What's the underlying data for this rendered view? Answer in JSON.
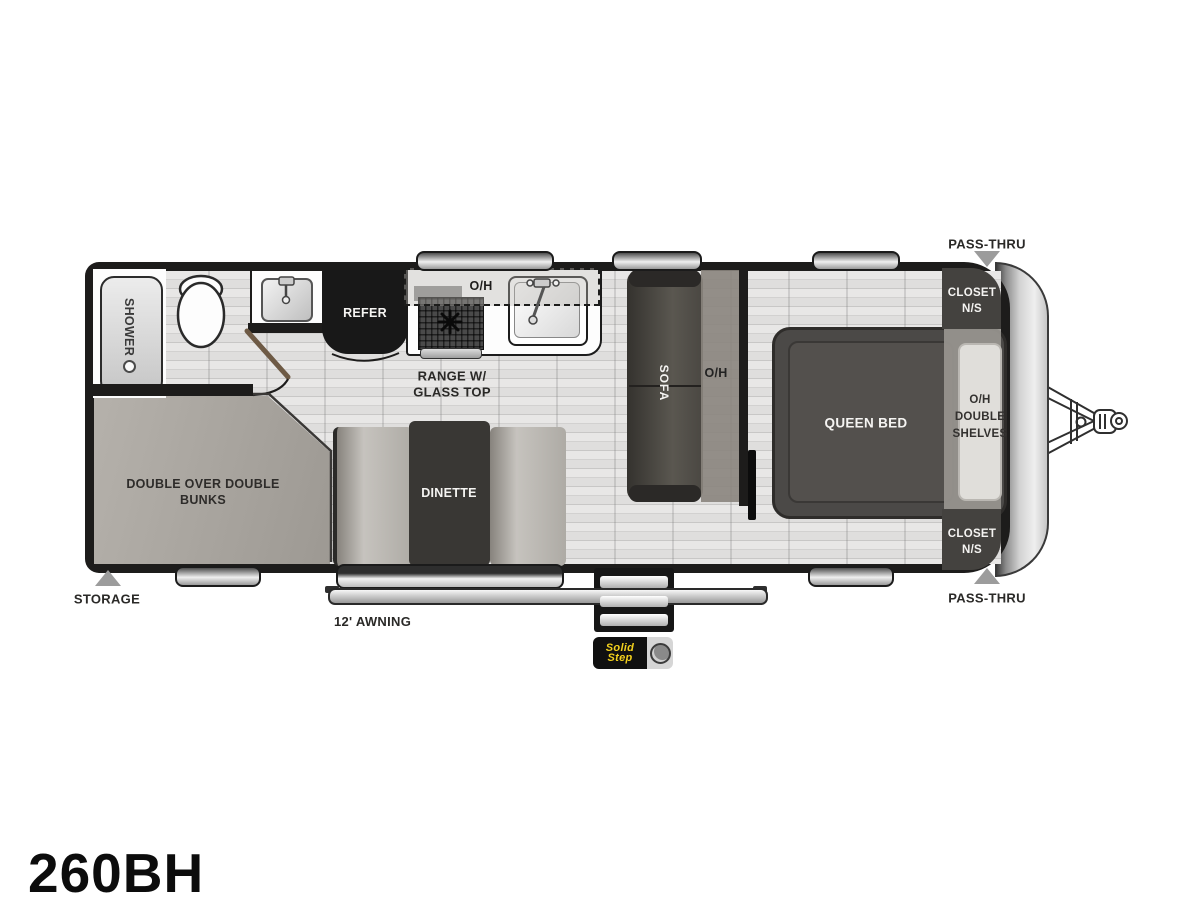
{
  "model": "260BH",
  "colors": {
    "wall": "#1d1c1b",
    "floor_light": "#e3e2e1",
    "furniture_dark": "#403e3b",
    "overhead_gray": "#8a847d",
    "arrow_gray": "#9c9c9c",
    "brand_yellow": "#f3d11d"
  },
  "rooms": {
    "bathroom": {
      "shower": "SHOWER"
    },
    "kitchen": {
      "refer": "REFER",
      "overhead": "O/H",
      "range_line1": "RANGE W/",
      "range_line2": "GLASS TOP"
    },
    "living": {
      "sofa": "SOFA",
      "sofa_overhead": "O/H",
      "dinette": "DINETTE"
    },
    "bunk_room": {
      "line1": "DOUBLE OVER DOUBLE",
      "line2": "BUNKS"
    },
    "bedroom": {
      "bed": "QUEEN BED",
      "shelves_line1": "O/H",
      "shelves_line2": "DOUBLE",
      "shelves_line3": "SHELVES",
      "closet_line1": "CLOSET",
      "closet_line2": "N/S"
    }
  },
  "exterior": {
    "pass_thru": "PASS-THRU",
    "storage": "STORAGE",
    "awning": "12' AWNING",
    "step_brand_line1": "Solid",
    "step_brand_line2": "Step"
  }
}
